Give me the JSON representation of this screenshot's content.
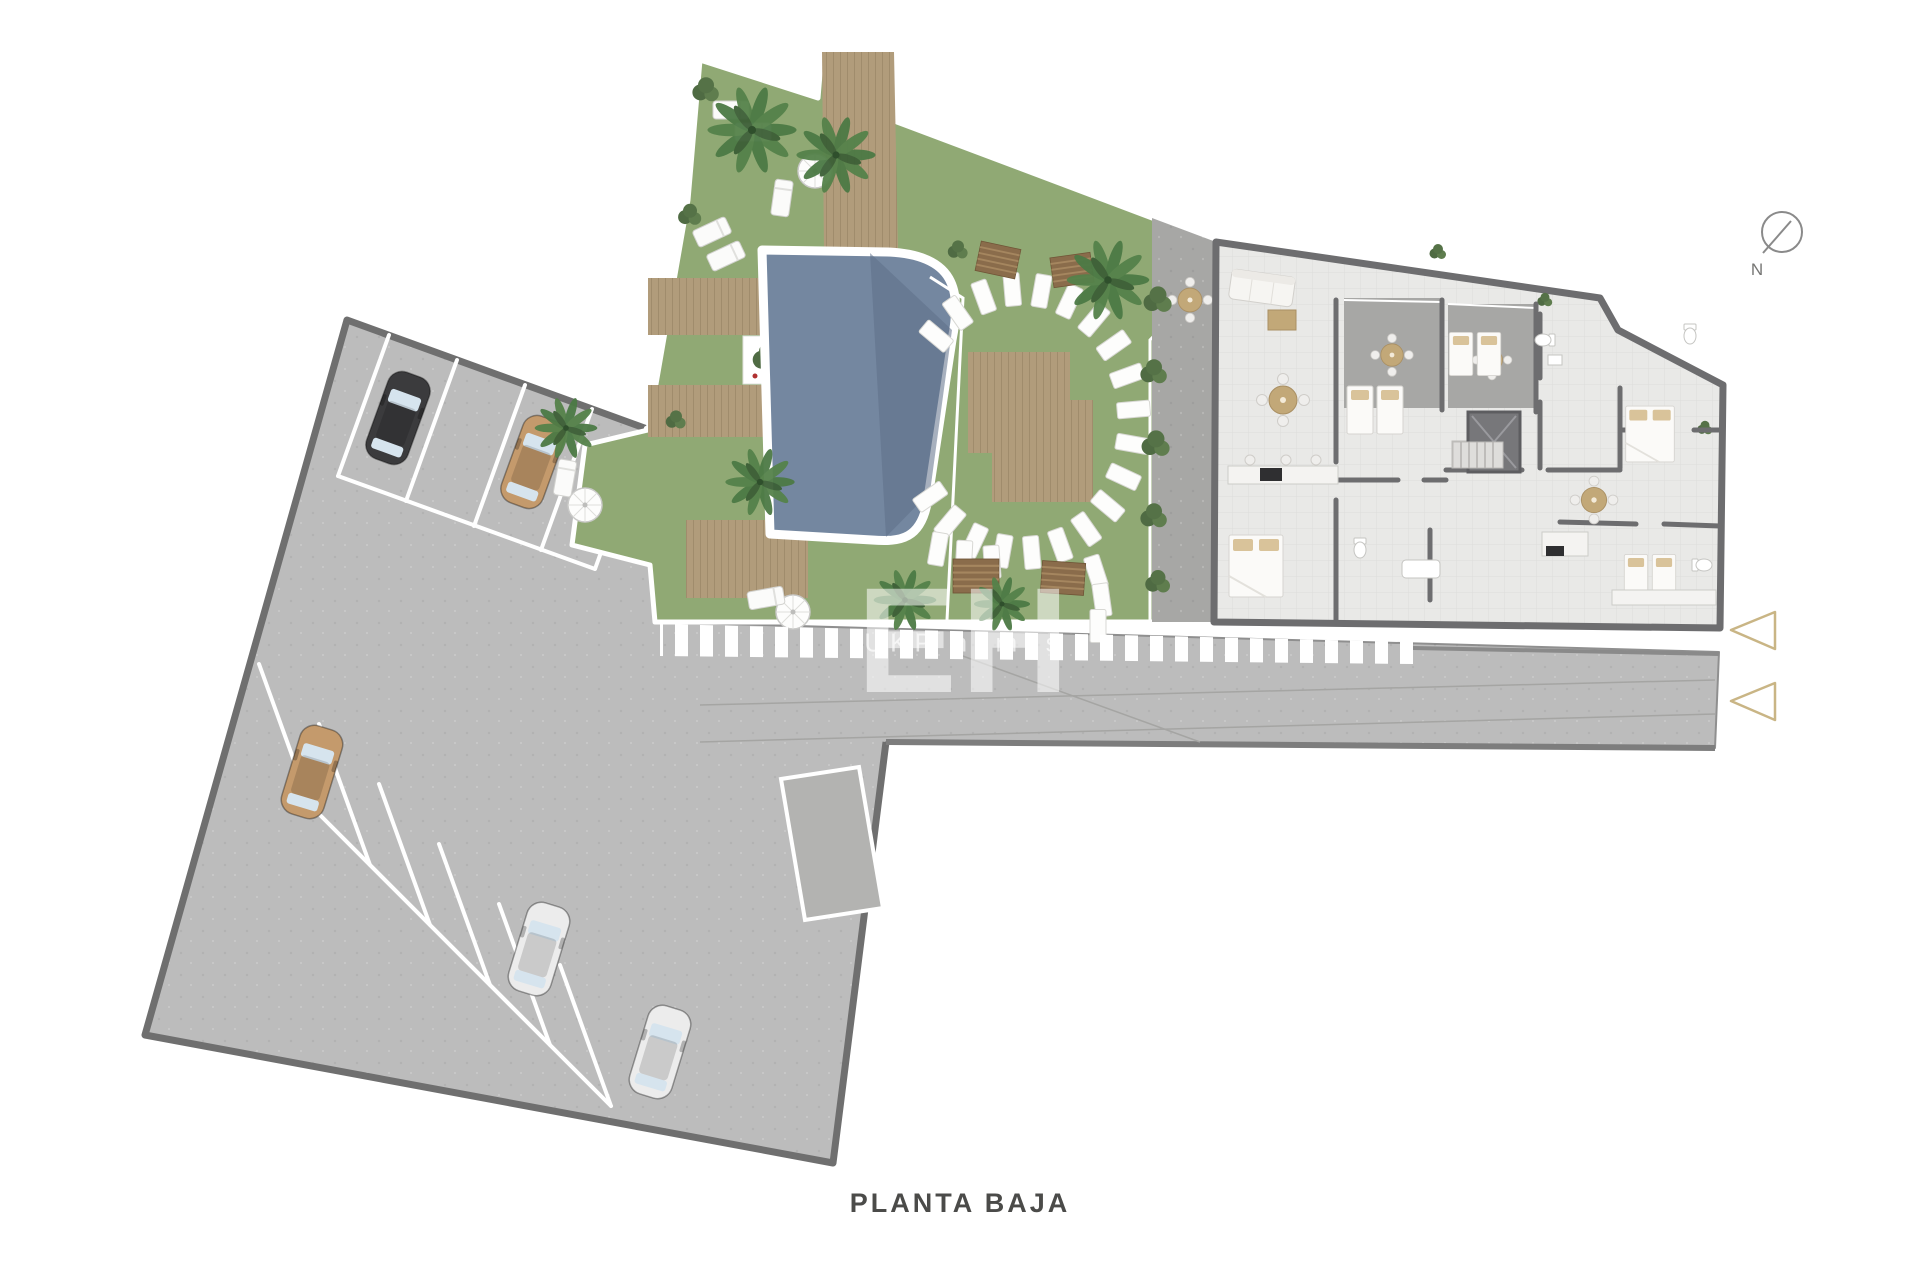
{
  "page": {
    "title": "PLANTA BAJA"
  },
  "compass": {
    "label": "N"
  },
  "watermark": {
    "initials": "EH",
    "brand": "UKP homes"
  },
  "colors": {
    "paving": "#bcbcbc",
    "paving_border": "#8a8a8a",
    "curb": "#6f6f6f",
    "grass": "#90a974",
    "pool": "#7487a0",
    "pool_deep": "#5e7089",
    "deck": "#b19c7b",
    "deck_slat": "#8a6c4b",
    "wall": "#6d6d6f",
    "floor": "#e9e9e7",
    "terrace": "#a7a7a5",
    "hedge": "#4f6b43",
    "palm": "#4c7a45",
    "car_black": "#3b3b3d",
    "car_tan": "#c49a6c",
    "car_white": "#ececec",
    "marking": "#ffffff",
    "accent_arrow": "#c9b585",
    "compass_stroke": "#8a8a8a",
    "furniture_white": "#fbfaf8",
    "furniture_tan": "#c2a878"
  }
}
